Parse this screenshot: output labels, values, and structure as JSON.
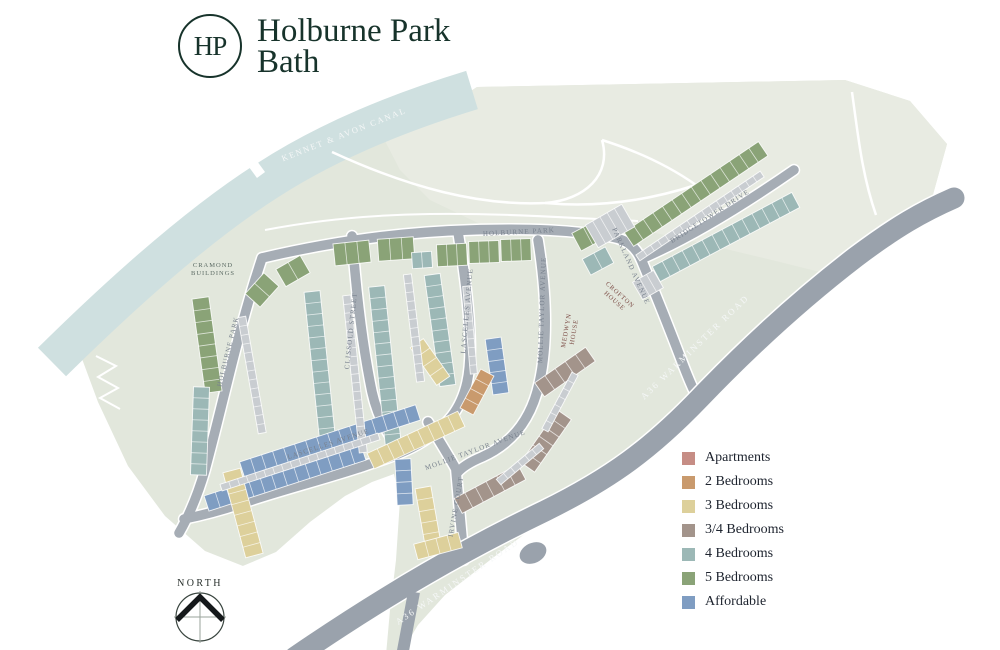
{
  "brand": {
    "monogram": "HP",
    "title_line1": "Holburne Park",
    "title_line2": "Bath",
    "color": "#17332b"
  },
  "compass": {
    "label": "NORTH"
  },
  "legend": {
    "items": [
      {
        "key": "apartments",
        "label": "Apartments",
        "color": "#c68d85"
      },
      {
        "key": "b2",
        "label": "2 Bedrooms",
        "color": "#c99a6d"
      },
      {
        "key": "b3",
        "label": "3 Bedrooms",
        "color": "#ddd09b"
      },
      {
        "key": "b34",
        "label": "3/4 Bedrooms",
        "color": "#a3948b"
      },
      {
        "key": "b4",
        "label": "4 Bedrooms",
        "color": "#9cb8b6"
      },
      {
        "key": "b5",
        "label": "5 Bedrooms",
        "color": "#8aa377"
      },
      {
        "key": "aff",
        "label": "Affordable",
        "color": "#7f9dc2"
      }
    ]
  },
  "map": {
    "labels": {
      "canal": "KENNET & AVON CANAL",
      "holburne_park": "HOLBURNE PARK",
      "bridgetower": "BRIDGETOWER DRIVE",
      "parkland": "PARKLAND AVENUE",
      "clissold": "CLISSOLD STREET",
      "lascelles": "LASCELLES AVENUE",
      "mollie": "MOLLIE TAYLOR AVENUE",
      "irvine": "IRVINE COURT",
      "a36": "A36  WARMINSTER ROAD",
      "cramond_1": "CRAMOND",
      "cramond_2": "BUILDINGS",
      "medwyn_1": "MEDWYN",
      "medwyn_2": "HOUSE",
      "crofton_1": "CROFTON",
      "crofton_2": "HOUSE"
    },
    "colors": {
      "site": "#e2e7dc",
      "parkland": "#e8ebe2",
      "canal": "#cfe0e0",
      "road_major": "#9aa2ac",
      "road_minor": "#a6adb5",
      "garage": "#c9cdd1"
    },
    "tree_palette": [
      "#83b593",
      "#b6d1b2",
      "#cedfc9",
      "#c0a98c"
    ],
    "rows": [
      [
        "b5",
        696,
        194,
        162,
        17,
        -34
      ],
      [
        "b5",
        207,
        345,
        95,
        17,
        82
      ],
      [
        "b5",
        262,
        290,
        28,
        20,
        -48
      ],
      [
        "b5",
        293,
        271,
        28,
        20,
        -30
      ],
      [
        "b5",
        352,
        253,
        36,
        22,
        -6
      ],
      [
        "b5",
        396,
        249,
        36,
        22,
        -4
      ],
      [
        "b5",
        452,
        255,
        30,
        22,
        -3
      ],
      [
        "b5",
        484,
        252,
        30,
        22,
        -2
      ],
      [
        "b5",
        516,
        250,
        30,
        22,
        -2
      ],
      [
        "b5",
        588,
        236,
        26,
        20,
        -28
      ],
      [
        "b4",
        726,
        237,
        158,
        17,
        -28
      ],
      [
        "b4",
        321,
        377,
        172,
        16,
        84
      ],
      [
        "b4",
        385,
        366,
        160,
        16,
        84
      ],
      [
        "b4",
        440,
        330,
        112,
        16,
        82
      ],
      [
        "b4",
        200,
        431,
        88,
        16,
        92
      ],
      [
        "b4",
        598,
        261,
        26,
        18,
        -28
      ],
      [
        "b4",
        422,
        260,
        20,
        16,
        -4
      ],
      [
        "aff",
        330,
        441,
        185,
        16,
        -18
      ],
      [
        "aff",
        285,
        478,
        165,
        16,
        -18
      ],
      [
        "aff",
        497,
        366,
        56,
        16,
        82
      ],
      [
        "aff",
        404,
        482,
        46,
        16,
        87
      ],
      [
        "b3",
        243,
        513,
        88,
        18,
        75
      ],
      [
        "b3",
        416,
        440,
        100,
        17,
        -25
      ],
      [
        "b3",
        428,
        516,
        58,
        16,
        80
      ],
      [
        "b3",
        438,
        546,
        46,
        16,
        -15
      ],
      [
        "b3",
        430,
        362,
        46,
        16,
        55
      ],
      [
        "b34",
        565,
        372,
        62,
        17,
        -35
      ],
      [
        "b34",
        546,
        441,
        64,
        17,
        -55
      ],
      [
        "b34",
        490,
        489,
        72,
        17,
        -28
      ],
      [
        "b2",
        477,
        392,
        44,
        15,
        -62
      ],
      [
        "g",
        700,
        216,
        150,
        7,
        -34
      ],
      [
        "g",
        252,
        375,
        118,
        8,
        80
      ],
      [
        "g",
        355,
        374,
        158,
        8,
        84
      ],
      [
        "g",
        414,
        328,
        108,
        8,
        83
      ],
      [
        "g",
        300,
        462,
        166,
        7,
        -18
      ],
      [
        "g",
        470,
        330,
        88,
        7,
        85
      ],
      [
        "g",
        610,
        226,
        42,
        26,
        -30
      ],
      [
        "g",
        648,
        285,
        24,
        20,
        -30
      ],
      [
        "g",
        520,
        464,
        56,
        7,
        -40
      ],
      [
        "g",
        560,
        402,
        64,
        7,
        -62
      ]
    ],
    "apartments": [
      {
        "key": "cramond",
        "cx": 219,
        "cy": 297,
        "w": 30,
        "h": 24,
        "a": 18
      },
      {
        "key": "medwyn",
        "cx": 569,
        "cy": 330,
        "w": 40,
        "h": 54,
        "a": 10
      },
      {
        "key": "crofton",
        "cx": 618,
        "cy": 298,
        "w": 34,
        "h": 34,
        "a": 45
      }
    ],
    "trees": [
      [
        300,
        182,
        7,
        0
      ],
      [
        322,
        168,
        5,
        1
      ],
      [
        343,
        192,
        6,
        2
      ],
      [
        367,
        177,
        8,
        0
      ],
      [
        388,
        163,
        5,
        3
      ],
      [
        398,
        188,
        7,
        1
      ],
      [
        420,
        174,
        6,
        0
      ],
      [
        442,
        197,
        7,
        1
      ],
      [
        462,
        182,
        5,
        3
      ],
      [
        482,
        152,
        6,
        1
      ],
      [
        503,
        167,
        8,
        0
      ],
      [
        522,
        144,
        6,
        2
      ],
      [
        547,
        160,
        7,
        0
      ],
      [
        572,
        150,
        5,
        1
      ],
      [
        597,
        172,
        6,
        3
      ],
      [
        622,
        152,
        7,
        0
      ],
      [
        652,
        162,
        5,
        1
      ],
      [
        682,
        147,
        6,
        0
      ],
      [
        702,
        172,
        7,
        1
      ],
      [
        732,
        157,
        8,
        0
      ],
      [
        762,
        150,
        6,
        1
      ],
      [
        766,
        186,
        7,
        0
      ],
      [
        790,
        167,
        5,
        3
      ],
      [
        822,
        157,
        7,
        0
      ],
      [
        852,
        172,
        5,
        1
      ],
      [
        882,
        187,
        6,
        1
      ],
      [
        737,
        192,
        5,
        2
      ],
      [
        256,
        207,
        6,
        1
      ],
      [
        276,
        224,
        5,
        0
      ],
      [
        233,
        242,
        5,
        2
      ],
      [
        210,
        262,
        4,
        1
      ],
      [
        158,
        292,
        5,
        1
      ],
      [
        147,
        322,
        4,
        0
      ],
      [
        172,
        352,
        5,
        2
      ],
      [
        190,
        382,
        4,
        1
      ],
      [
        347,
        299,
        5,
        0
      ],
      [
        253,
        333,
        5,
        2
      ],
      [
        312,
        489,
        4,
        0
      ],
      [
        370,
        473,
        4,
        1
      ],
      [
        345,
        425,
        4,
        2
      ],
      [
        520,
        270,
        4,
        1
      ],
      [
        600,
        332,
        8,
        0
      ],
      [
        624,
        347,
        9,
        1
      ],
      [
        612,
        370,
        7,
        0
      ],
      [
        637,
        382,
        8,
        3
      ],
      [
        650,
        357,
        6,
        1
      ],
      [
        592,
        392,
        6,
        2
      ],
      [
        614,
        400,
        5,
        3
      ],
      [
        642,
        322,
        6,
        1
      ],
      [
        540,
        489,
        6,
        0
      ],
      [
        558,
        471,
        5,
        1
      ],
      [
        576,
        453,
        6,
        0
      ],
      [
        596,
        434,
        5,
        1
      ],
      [
        616,
        414,
        6,
        0
      ],
      [
        638,
        394,
        5,
        1
      ],
      [
        660,
        373,
        6,
        2
      ],
      [
        684,
        350,
        5,
        1
      ],
      [
        710,
        327,
        5,
        0
      ],
      [
        737,
        304,
        6,
        1
      ],
      [
        800,
        250,
        5,
        3
      ],
      [
        828,
        234,
        6,
        1
      ],
      [
        447,
        587,
        7,
        1
      ],
      [
        480,
        561,
        5,
        2
      ],
      [
        432,
        562,
        5,
        0
      ],
      [
        237,
        569,
        6,
        1
      ],
      [
        868,
        205,
        6,
        2
      ],
      [
        838,
        182,
        5,
        3
      ],
      [
        900,
        162,
        4,
        1
      ]
    ]
  }
}
